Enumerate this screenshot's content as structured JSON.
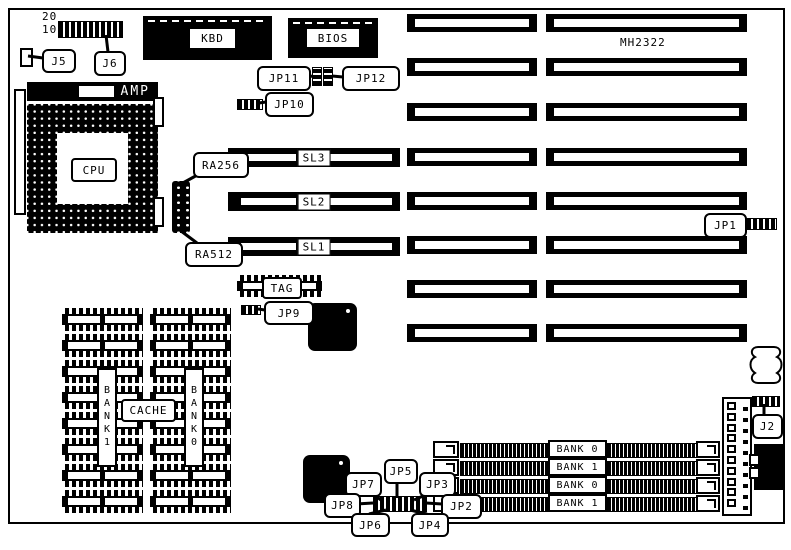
{
  "board": {
    "model": "MH2322"
  },
  "top_left": {
    "pin_20": "20",
    "pin_10": "10",
    "j5": "J5",
    "j6": "J6"
  },
  "chips": {
    "kbd": "KBD",
    "bios": "BIOS",
    "amp": "AMP",
    "cpu": "CPU",
    "tag": "TAG"
  },
  "jumpers": {
    "jp1": "JP1",
    "jp2": "JP2",
    "jp3": "JP3",
    "jp4": "JP4",
    "jp5": "JP5",
    "jp6": "JP6",
    "jp7": "JP7",
    "jp8": "JP8",
    "jp9": "JP9",
    "jp10": "JP10",
    "jp11": "JP11",
    "jp12": "JP12",
    "j2": "J2"
  },
  "ram_callouts": {
    "ra256": "RA256",
    "ra512": "RA512"
  },
  "slots": {
    "sl3": "SL3",
    "sl2": "SL2",
    "sl1": "SL1"
  },
  "cache": {
    "bank_left": "BANK1",
    "label": "CACHE",
    "bank_right": "BANK0"
  },
  "simm": {
    "banks": [
      "BANK 0",
      "BANK 1",
      "BANK 0",
      "BANK 1"
    ]
  }
}
